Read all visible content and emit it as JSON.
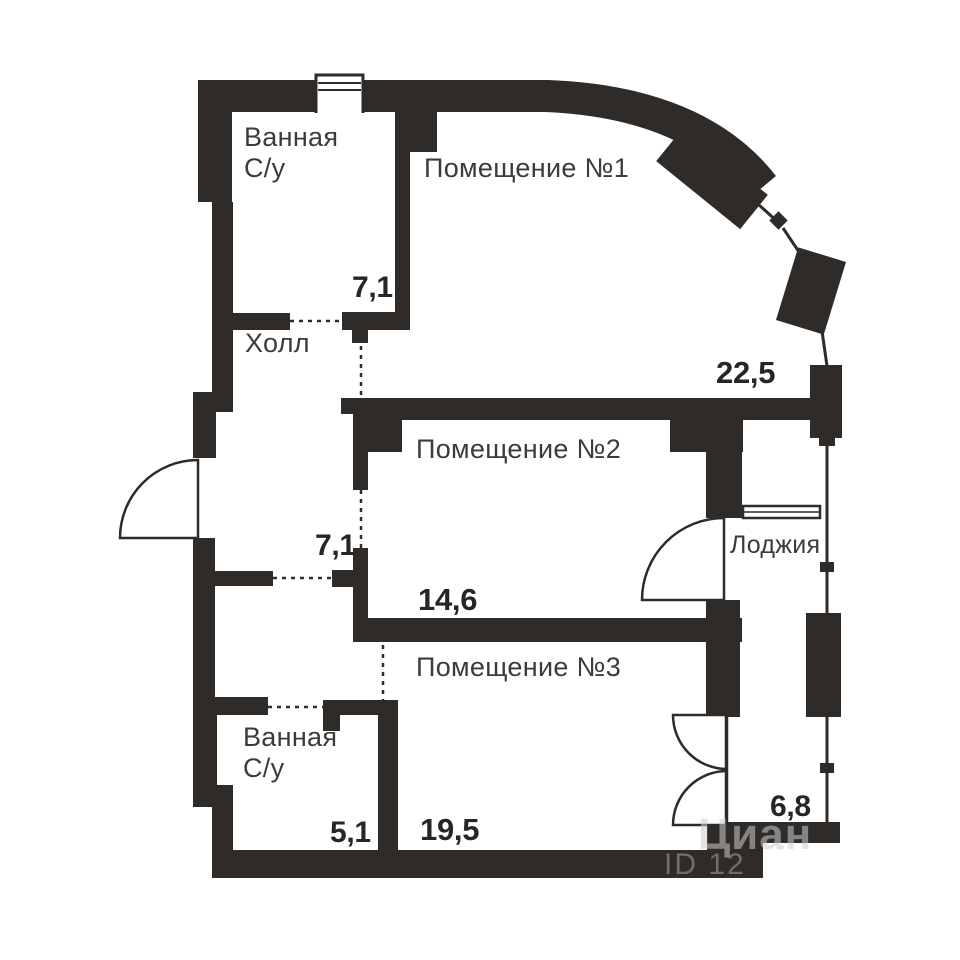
{
  "plan": {
    "rooms": {
      "bathroom1": {
        "label": "Ванная",
        "label2": "С/у",
        "area": "7,1"
      },
      "room1": {
        "label": "Помещение №1",
        "area": "22,5"
      },
      "hall": {
        "label": "Холл",
        "area": "7,1"
      },
      "room2": {
        "label": "Помещение №2",
        "area": "14,6"
      },
      "loggia": {
        "label": "Лоджия",
        "area": "6,8"
      },
      "room3": {
        "label": "Помещение №3",
        "area": "19,5"
      },
      "bathroom2": {
        "label": "Ванная",
        "label2": "С/у",
        "area": "5,1"
      }
    },
    "watermark": {
      "line1": "Циан",
      "line2": "ID 12"
    },
    "colors": {
      "wall": "#2e2b29",
      "room_label": "#3d3b3a",
      "area_label": "#272525",
      "background": "#ffffff"
    }
  }
}
